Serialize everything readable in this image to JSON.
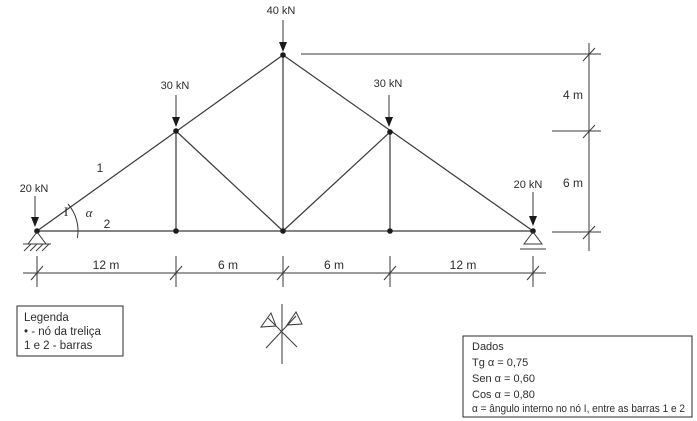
{
  "colors": {
    "line": "#3a3a3a",
    "text": "#2d2d2d",
    "node_dot": "#1a1a1a",
    "background": "#ffffff"
  },
  "truss": {
    "loads": {
      "apex": "40 kN",
      "left_mid": "30 kN",
      "right_mid": "30 kN",
      "left_support": "20 kN",
      "right_support": "20 kN"
    },
    "bar_1_label": "1",
    "bar_2_label": "2",
    "node_i_label": "I",
    "angle_label": "α"
  },
  "dimensions": {
    "bottom": [
      "12 m",
      "6 m",
      "6 m",
      "12 m"
    ],
    "right_top": "4 m",
    "right_bottom": "6 m"
  },
  "legend": {
    "title": "Legenda",
    "node_item": "• - nó da treliça",
    "bars_item": "1 e 2 - barras"
  },
  "dados": {
    "title": "Dados",
    "tg": "Tg α = 0,75",
    "sen": "Sen α = 0,60",
    "cos": "Cos α = 0,80",
    "note": "α = ângulo interno no nó I, entre as barras 1 e 2"
  }
}
